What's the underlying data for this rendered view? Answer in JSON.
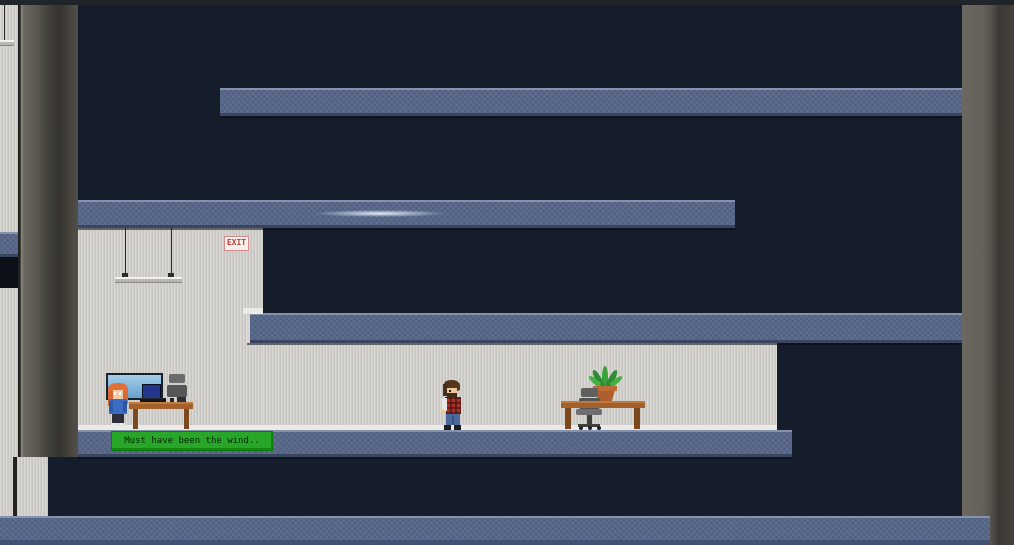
{
  "game": {
    "name": "pixel-stealth-office-platformer",
    "dialogue": {
      "text": "Must have been the wind.."
    },
    "signs": {
      "exit_label": "EXIT"
    },
    "palette": {
      "background_navy": "#151c2a",
      "platform_blue": "#56678a",
      "platform_highlight": "#8492ae",
      "platform_shadow": "#3a4660",
      "wall_gray": "#4e4c45",
      "wallpaper_gray": "#d4d2ce",
      "baseboard_white": "#eceae6",
      "dialogue_green": "#28a628",
      "exit_red": "#c23b3b",
      "desk_wood": "#a2602c",
      "tv_screen_sky": "#7fb3da",
      "pc_monitor_blue": "#24368a",
      "plant_green": "#3aa23d",
      "pot_clay": "#ad5f2e",
      "npc_hair_orange": "#e0703a",
      "npc_jacket_blue": "#3d6cc4",
      "player_shirt_red": "#a83028",
      "player_jeans_blue": "#4a699b"
    },
    "entities": [
      {
        "id": "npc-office-worker",
        "description": "orange-haired NPC in blue jacket beside wall TV desk, speaking"
      },
      {
        "id": "player-character",
        "description": "bearded character in red plaid shirt standing mid-room"
      }
    ],
    "props": [
      "wall-tv",
      "desk-computer",
      "office-chair",
      "office-desk",
      "ceiling-lamp",
      "potted-plant",
      "exit-sign"
    ]
  }
}
